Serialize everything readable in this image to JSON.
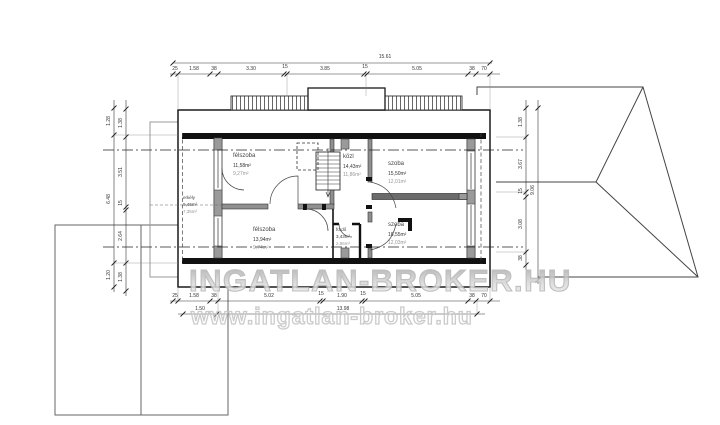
{
  "watermark": {
    "title": "INGATLAN-BROKER.HU",
    "url": "www.ingatlan-broker.hu"
  },
  "rooms": [
    {
      "name": "félszoba",
      "area1": "11,58m²",
      "area2": "9,27m²"
    },
    {
      "name": "erkély",
      "area1": "9,46m²",
      "area2": "7,35m²"
    },
    {
      "name": "félszoba",
      "area1": "13,94m²",
      "area2": "9,74m²"
    },
    {
      "name": "közl",
      "area1": "14,43m²",
      "area2": "11,86m²"
    },
    {
      "name": "szoba",
      "area1": "15,50m²",
      "area2": "12,01m²"
    },
    {
      "name": "szoba",
      "area1": "16,55m²",
      "area2": "12,03m²"
    },
    {
      "name": "fürdő",
      "area1": "3,43m²",
      "area2": "2,96m²"
    }
  ],
  "dimensions": {
    "top_total": "15.61",
    "top": [
      "25",
      "1.58",
      "38",
      "3.30",
      "15",
      "3.85",
      "15",
      "5.05",
      "38",
      "70"
    ],
    "bottom": [
      "25",
      "1.58",
      "38",
      "5.02",
      "15",
      "1.90",
      "15",
      "5.05",
      "38",
      "70"
    ],
    "bottom_sub": [
      "1.50",
      "13.98"
    ],
    "left_outer": [
      "1.28",
      "6.48",
      "1.20"
    ],
    "left_inner": [
      "1.38",
      "3.51",
      "15",
      "2.64",
      "1.38"
    ],
    "right_inner": [
      "1.38",
      "3.67",
      "15",
      "3.08",
      "38"
    ],
    "right_outer": "9.06"
  },
  "colors": {
    "line": "#333333",
    "wall_fill": "#9a9a9a",
    "watermark": "#c0c0c0"
  }
}
